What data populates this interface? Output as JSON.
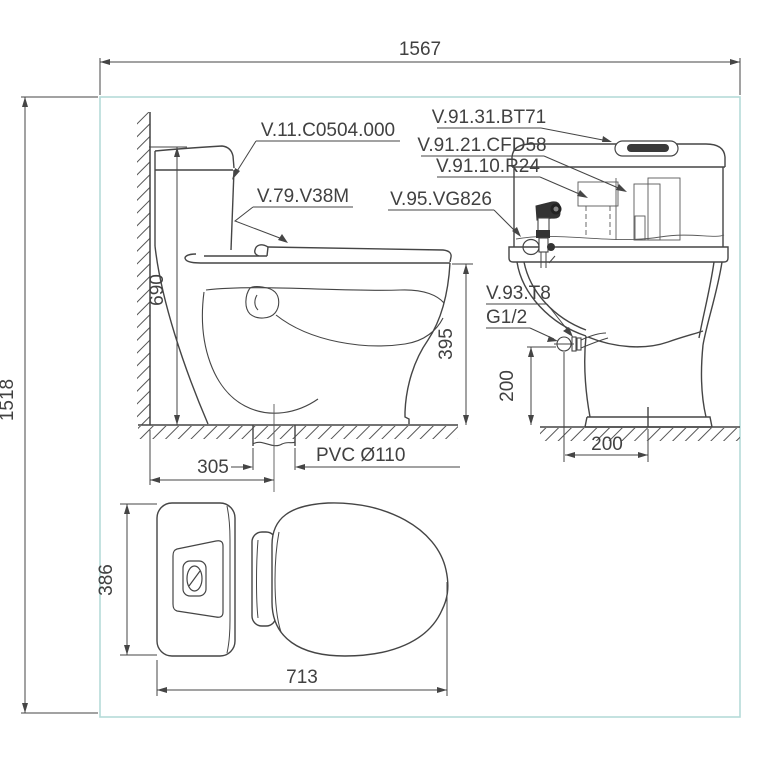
{
  "title": "One-piece toilet installation technical drawing",
  "colors": {
    "line": "#454545",
    "thin_line": "#5a5a5a",
    "accent_border": "#b5dbd9",
    "text": "#414141",
    "dark_fill": "#333333"
  },
  "overall": {
    "width": "1567",
    "height": "1518"
  },
  "side_view": {
    "tank_height": "690",
    "rim_height": "395",
    "drain_offset": "305",
    "drain_label": "PVC Ø110",
    "tank_code": "V.11.C0504.000",
    "seat_code": "V.79.V38M"
  },
  "front_view": {
    "inlet_height": "200",
    "inlet_offset": "200",
    "flush_button_code": "V.91.31.BT71",
    "flush_valve_code": "V.91.21.CFD58",
    "fill_valve_code": "V.91.10.R24",
    "sprayer_code": "V.95.VG826",
    "angle_valve_code": "V.93.T8",
    "thread_size": "G1/2"
  },
  "top_view": {
    "width": "386",
    "depth": "713"
  }
}
